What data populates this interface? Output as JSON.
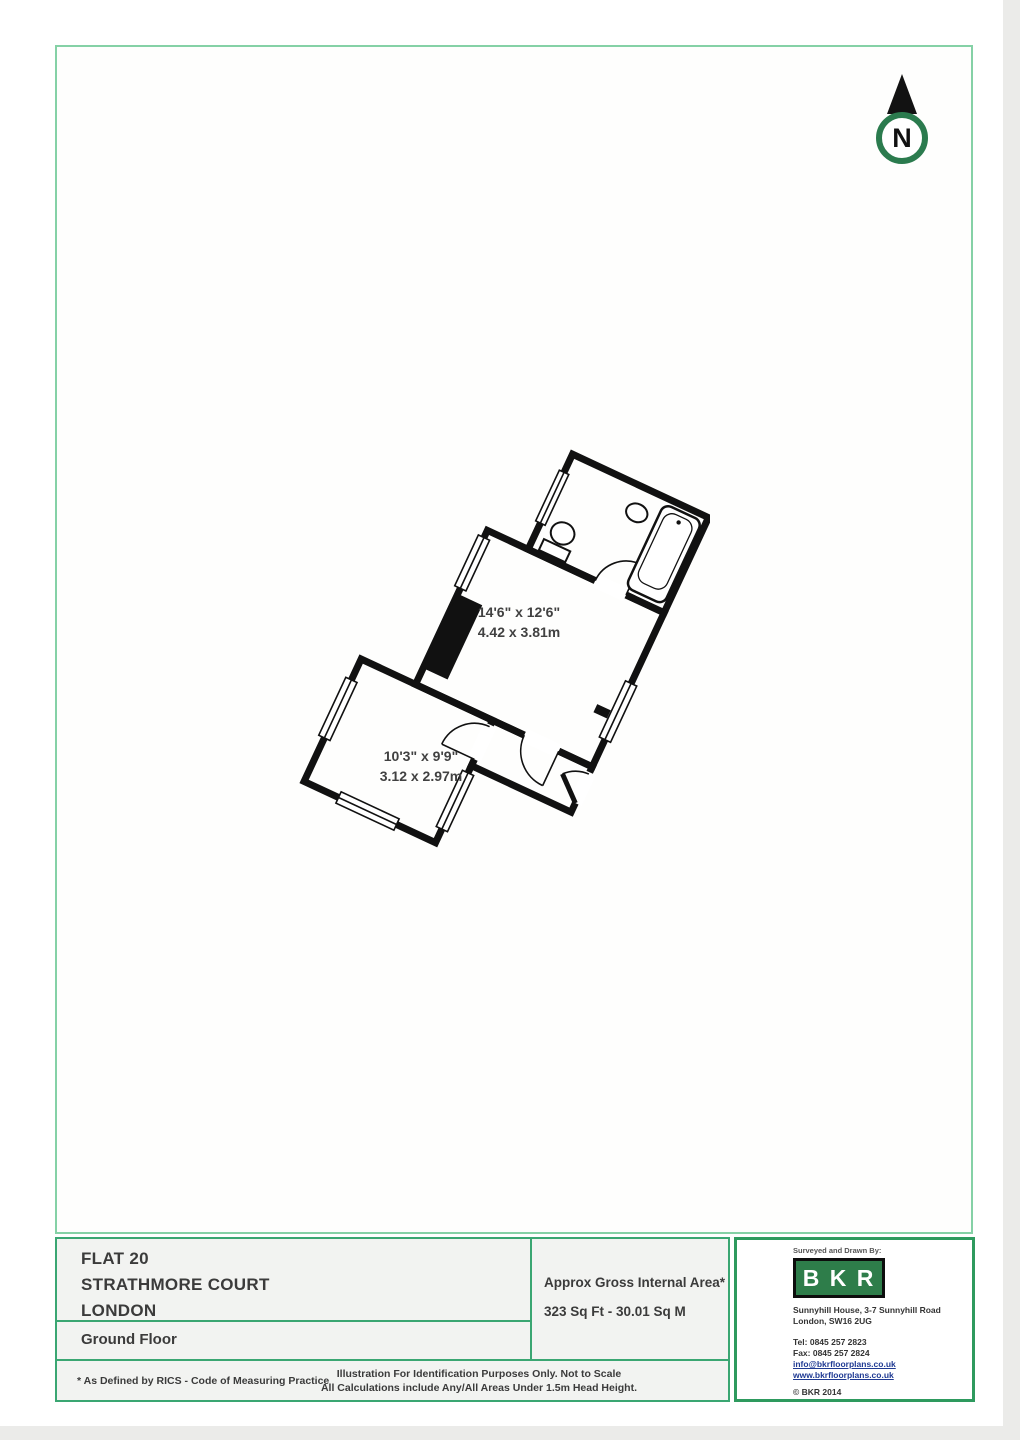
{
  "compass": {
    "label": "N"
  },
  "plan": {
    "room1": {
      "imperial": "14'6\" x 12'6\"",
      "metric": "4.42 x 3.81m"
    },
    "room2": {
      "imperial": "10'3\" x 9'9\"",
      "metric": "3.12 x 2.97m"
    }
  },
  "footer": {
    "property": {
      "line1": "FLAT 20",
      "line2": "STRATHMORE COURT",
      "line3": "LONDON"
    },
    "floor": "Ground Floor",
    "area": {
      "title": "Approx Gross Internal Area*",
      "value": "323 Sq Ft  - 30.01 Sq M"
    },
    "notes": {
      "rics": "* As Defined by RICS - Code of Measuring Practice",
      "line1": "Illustration For Identification Purposes Only.  Not to Scale",
      "line2": "All Calculations include Any/All Areas Under 1.5m Head Height."
    },
    "brand": {
      "surveyed": "Surveyed and Drawn By:",
      "logo_letters": "B K R",
      "addr1": "Sunnyhill House, 3-7 Sunnyhill Road",
      "addr2": "London, SW16 2UG",
      "tel": "Tel:  0845 257 2823",
      "fax": "Fax: 0845 257 2824",
      "email": "info@bkrfloorplans.co.uk",
      "web": "www.bkrfloorplans.co.uk",
      "copyright": "© BKR 2014"
    }
  },
  "colors": {
    "border_light": "#85d1a6",
    "border_mid": "#3aa672",
    "border_dark": "#2e9a5e",
    "logo_green": "#2e7d4a",
    "compass_green": "#2b7b4e",
    "wall_black": "#111111"
  }
}
